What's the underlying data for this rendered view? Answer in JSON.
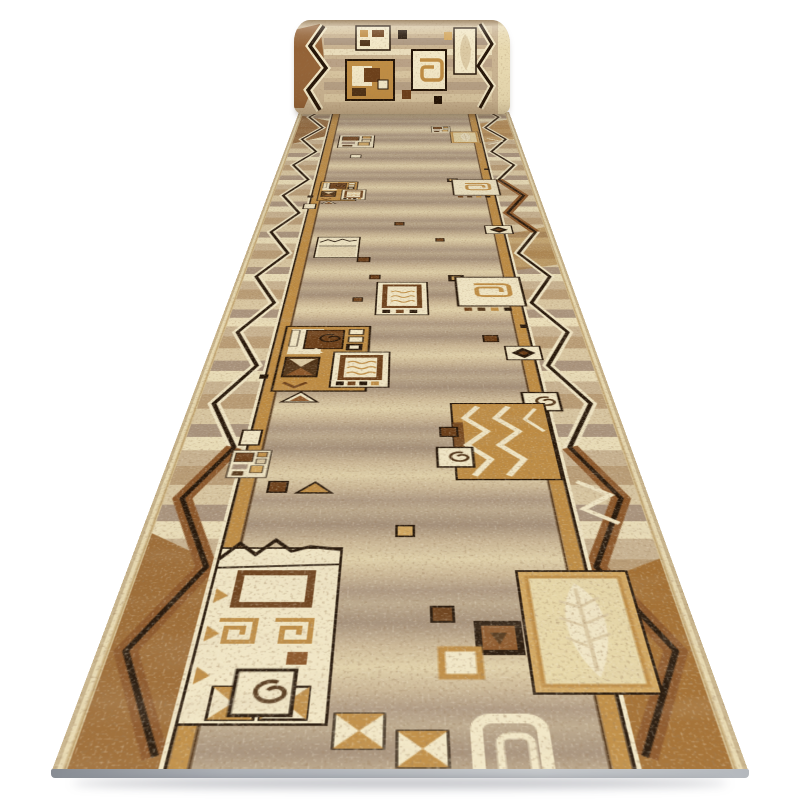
{
  "scene": {
    "type": "product-photo",
    "subject": "Beige carpet runner rug with geometric folk pattern, shown in perspective with far end rolled up, on white background",
    "background": "#ffffff"
  },
  "palette": {
    "cream": "#f2e7c6",
    "selvage": "#e8d9b0",
    "base": "#c9b391",
    "sand": "#dbc9a3",
    "taupe": "#a6907b",
    "taupe_dark": "#937d69",
    "ochre": "#bf8c42",
    "ochre_light": "#d3a75e",
    "brown": "#8a5426",
    "brown_dark": "#6b3e18",
    "coffee": "#4e3115",
    "ink": "#221306",
    "edge_gray_1": "#878c93",
    "edge_gray_2": "#c7cacd",
    "page_bg": "#ffffff"
  },
  "motifs": [
    "zigzag-border",
    "stripe-border",
    "spiral-square",
    "concentric-square",
    "chevron-panel",
    "leaf-panel",
    "window-blocks",
    "terrace-panel",
    "bowtie-square",
    "diamond-square",
    "rounded-frame",
    "speckle-texture"
  ]
}
